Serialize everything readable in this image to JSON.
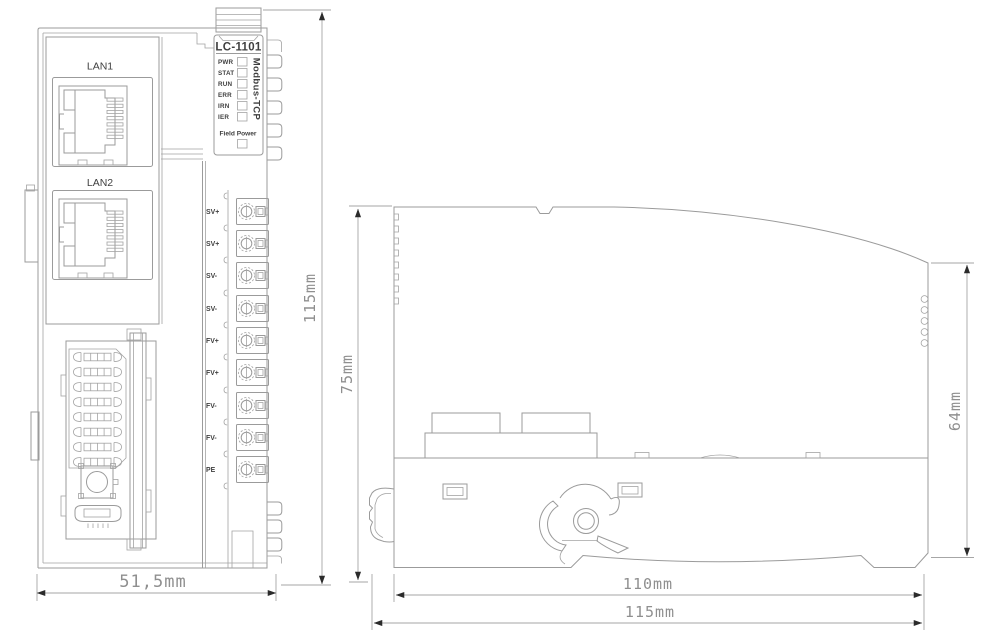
{
  "front_view": {
    "lan1_label": "LAN1",
    "lan2_label": "LAN2",
    "model": "LC-1101",
    "led_labels": [
      "PWR",
      "STAT",
      "RUN",
      "ERR",
      "IRN",
      "IER"
    ],
    "protocol_label": "Modbus-TCP",
    "field_power_label": "Field Power",
    "terminal_labels": [
      "SV+",
      "SV+",
      "SV-",
      "SV-",
      "FV+",
      "FV+",
      "FV-",
      "FV-",
      "PE"
    ]
  },
  "dimensions": {
    "front_width": "51,5mm",
    "front_height": "115mm",
    "side_upper_height": "75mm",
    "side_body_height": "64mm",
    "side_depth": "110mm",
    "side_total_depth": "115mm"
  },
  "colors": {
    "line": "#9b9b9b",
    "label_text": "#3f3f3f",
    "dimension_text": "#8f8f8f",
    "arrowhead": "#2b2b2b",
    "background": "#ffffff"
  }
}
